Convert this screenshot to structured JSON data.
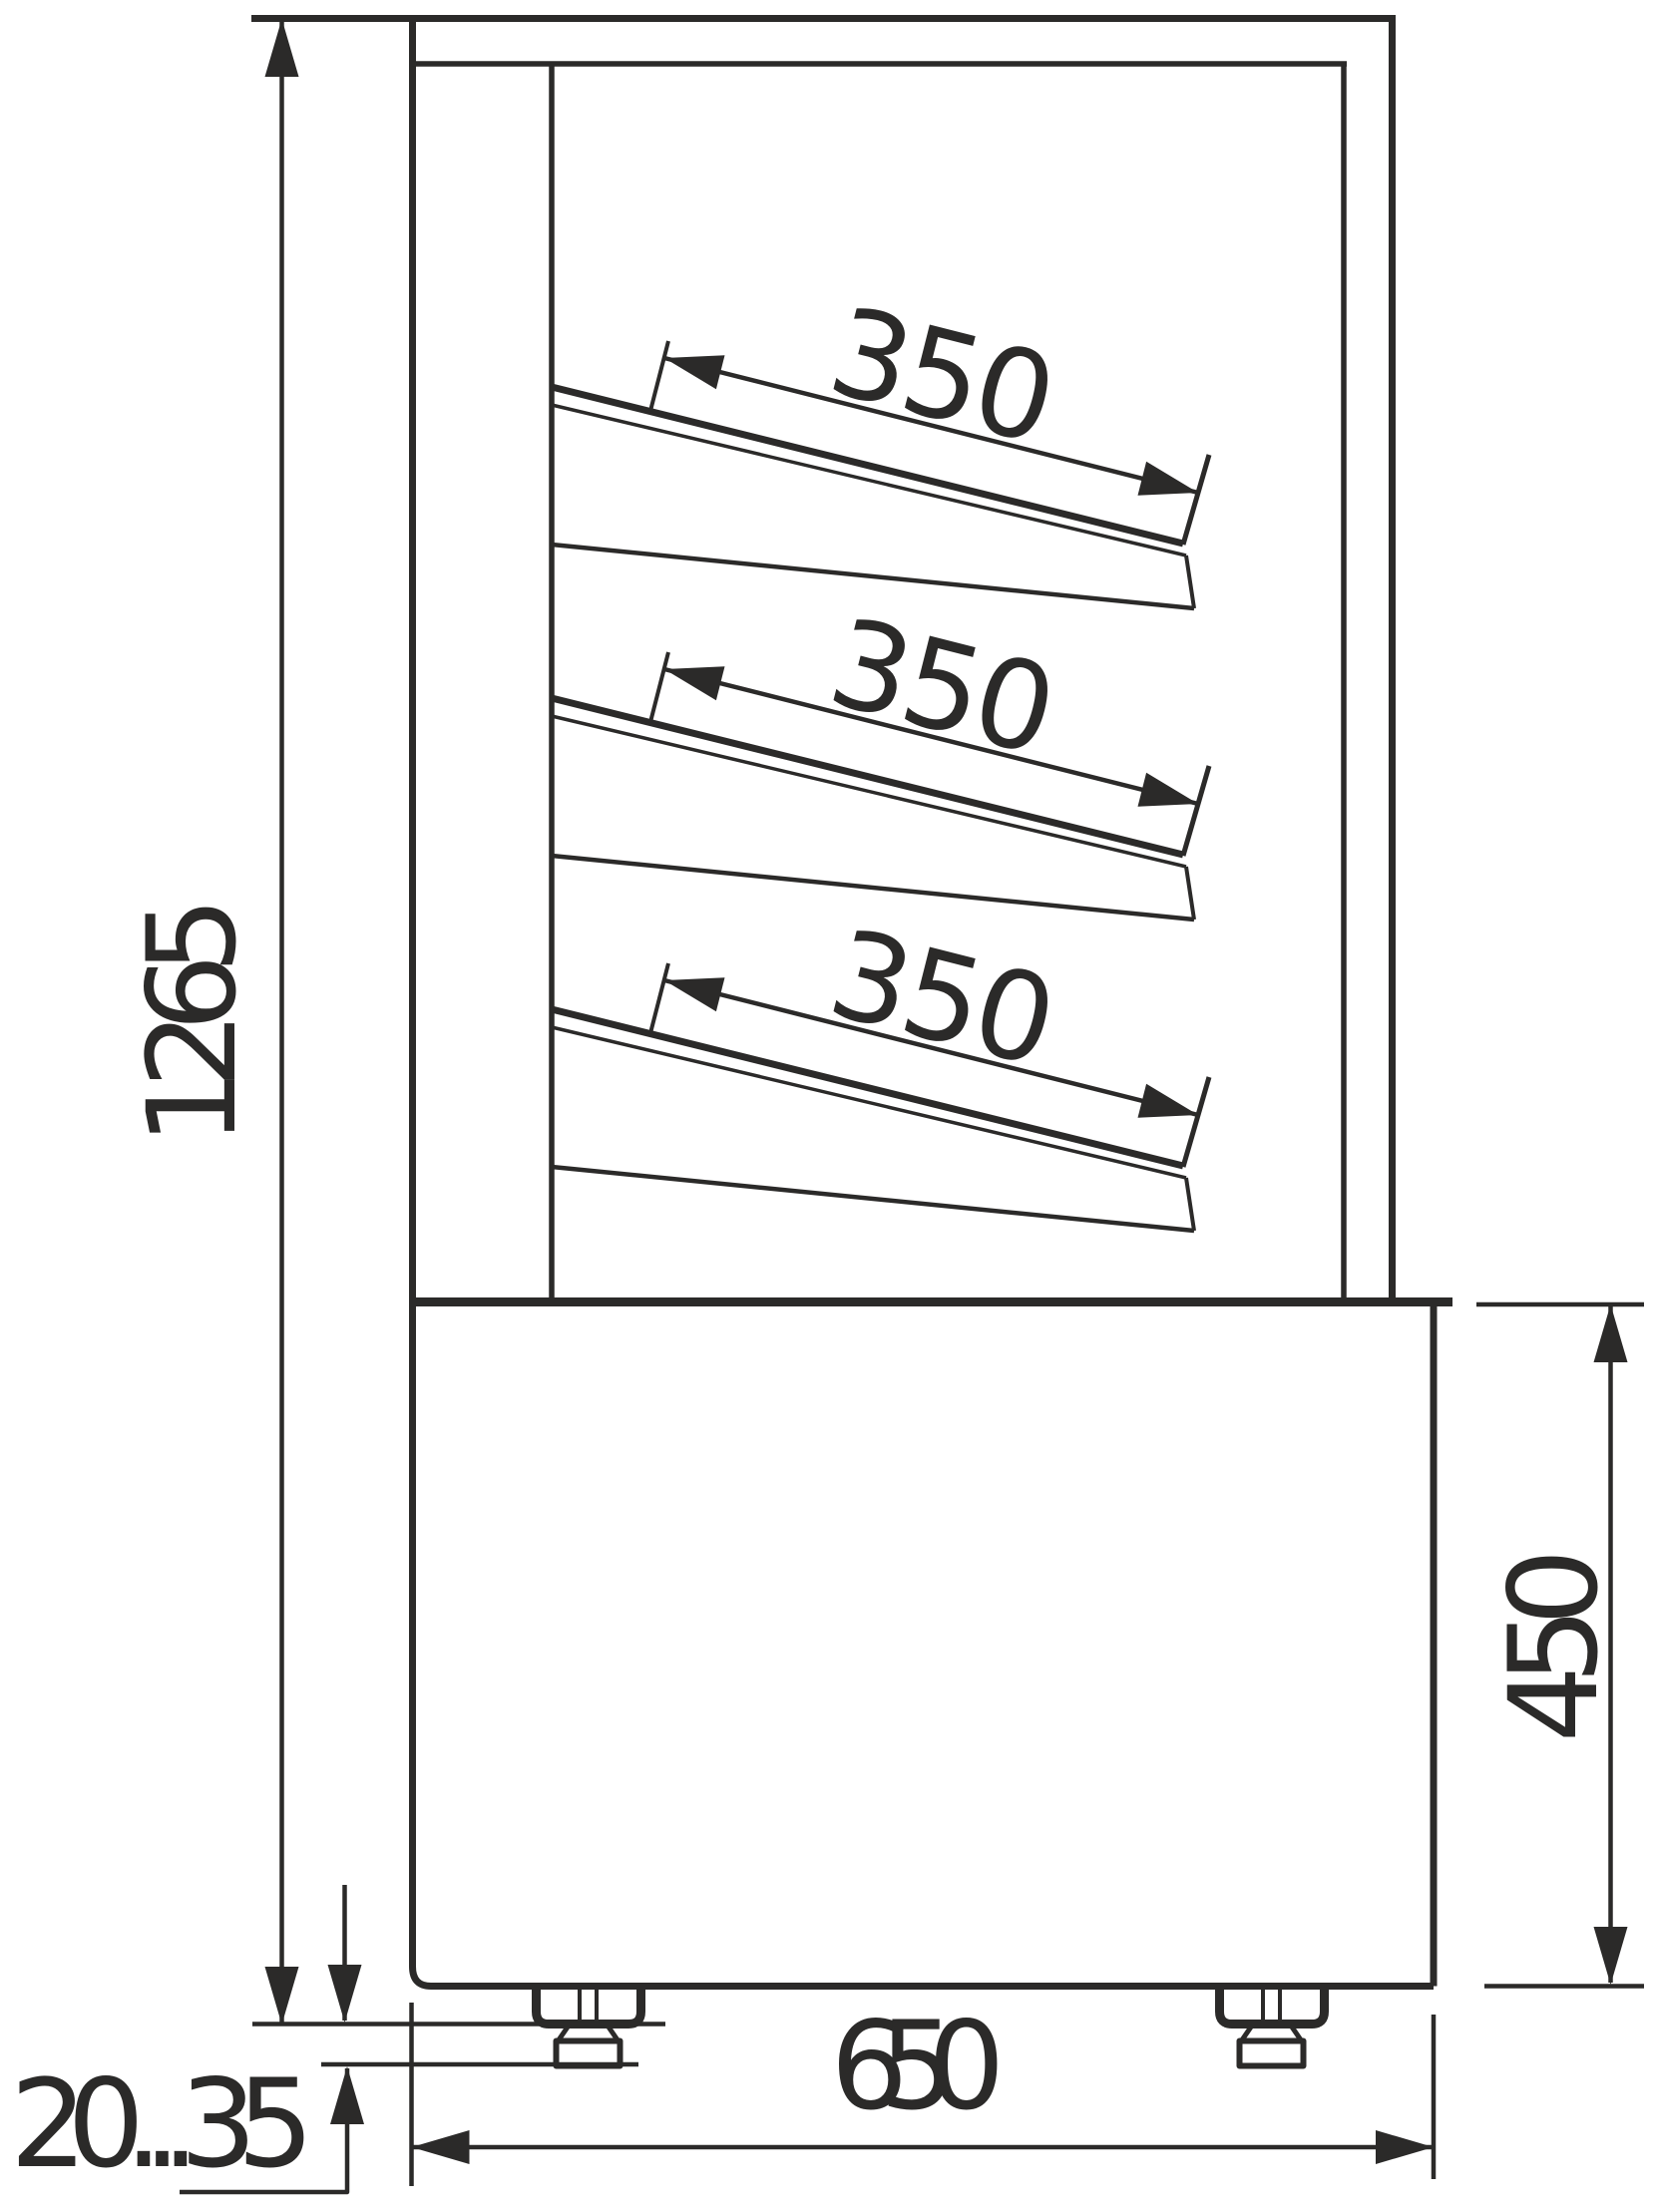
{
  "page": {
    "background": "#ffffff",
    "ink_color": "#2b2a29"
  },
  "drawing": {
    "dimensions": {
      "overall_height_label": "1265",
      "shelf1_depth_label": "350",
      "shelf2_depth_label": "350",
      "shelf3_depth_label": "350",
      "base_height_label": "450",
      "base_depth_label": "650",
      "leg_adjust_label": "20...35"
    }
  }
}
